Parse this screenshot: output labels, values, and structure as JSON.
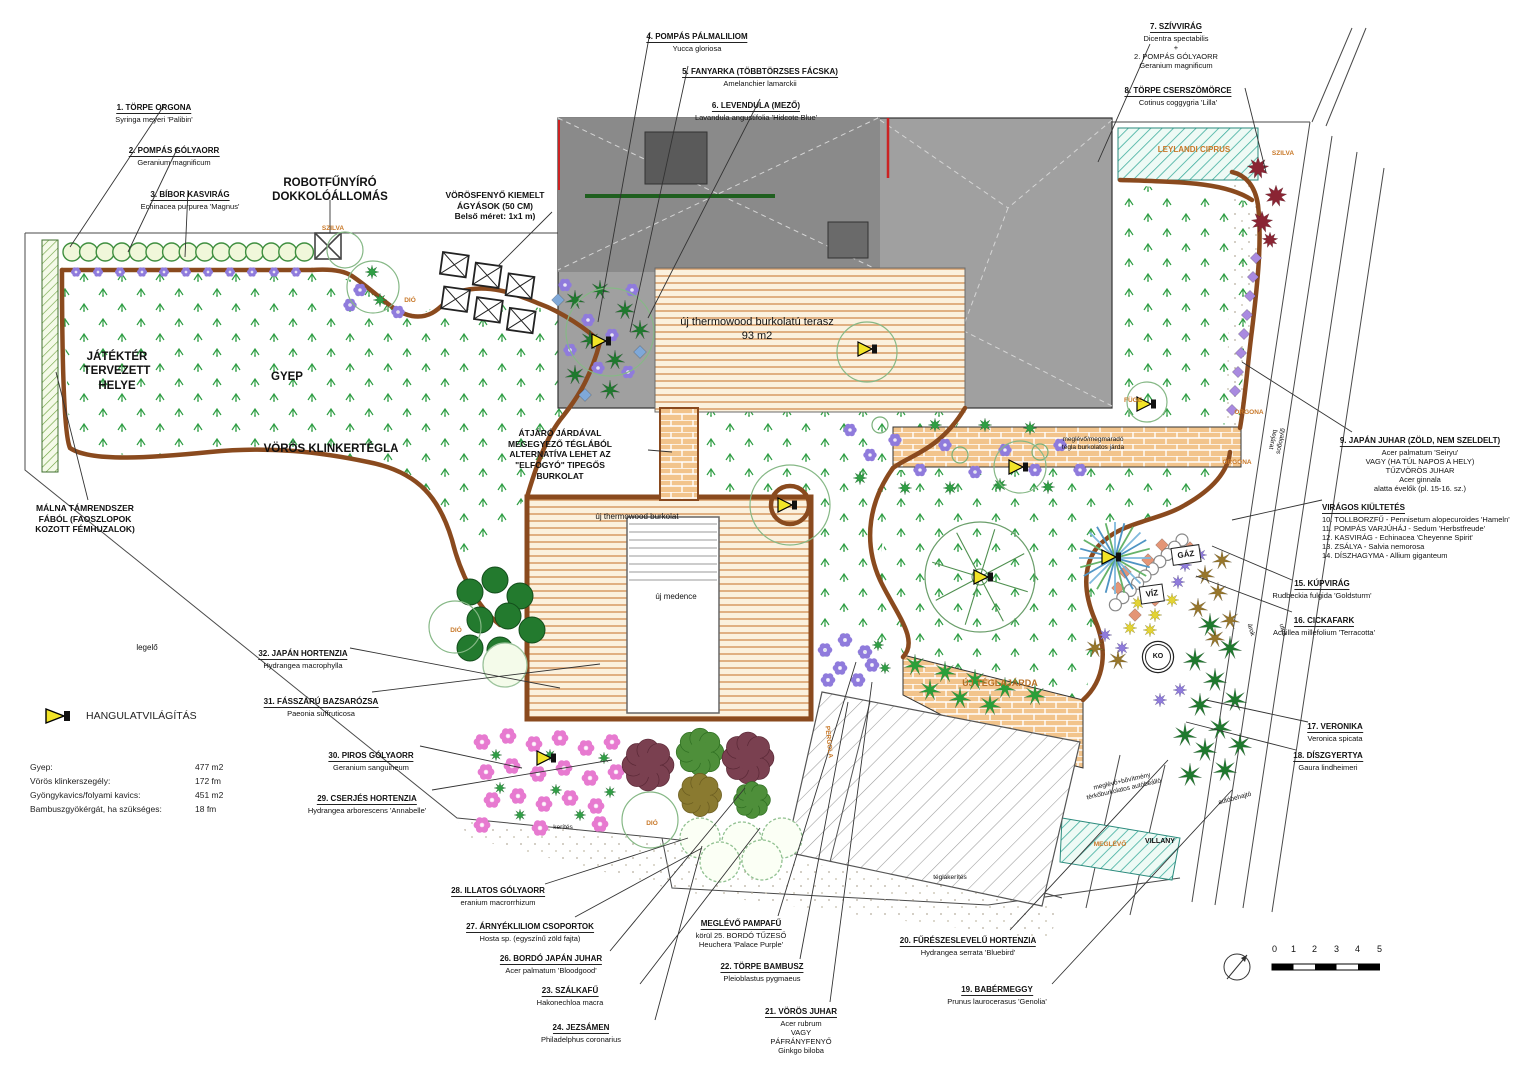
{
  "meta": {
    "drawing_type": "kertépítészeti terv (garden landscape plan)"
  },
  "colors": {
    "edging": "#8a4a1e",
    "lawn_symbol": "#2f9e44",
    "brick": "#e8b071",
    "terrace_stripe": "#d9a06b",
    "house": "#9a9a9a",
    "accent_orange": "#c87828",
    "lighting_yellow": "#f2e428",
    "teal_hatch": "#3fae9e",
    "red_accent": "#cc2222"
  },
  "plant_labels": [
    {
      "name": "plant-label-1",
      "title": "1. TÖRPE ORGONA",
      "latin": "Syringa meyeri 'Palibin'",
      "x": 154,
      "y": 96
    },
    {
      "name": "plant-label-2",
      "title": "2. POMPÁS GÓLYAORR",
      "latin": "Geranium magnificum",
      "x": 174,
      "y": 139
    },
    {
      "name": "plant-label-3",
      "title": "3. BÍBOR KASVIRÁG",
      "latin": "Echinacea purpurea 'Magnus'",
      "x": 190,
      "y": 183
    },
    {
      "name": "plant-label-4",
      "title": "4. POMPÁS PÁLMALILIOM",
      "latin": "Yucca gloriosa",
      "x": 697,
      "y": 25
    },
    {
      "name": "plant-label-5",
      "title": "5. FANYARKA (TÖBBTÖRZSES FÁCSKA)",
      "latin": "Amelanchier lamarckii",
      "x": 760,
      "y": 60
    },
    {
      "name": "plant-label-6",
      "title": "6. LEVENDULA (MEZŐ)",
      "latin": "Lavandula angustifolia 'Hidcote Blue'",
      "x": 756,
      "y": 94
    },
    {
      "name": "plant-label-7",
      "title": "7. SZÍVVIRÁG",
      "latin": "Dicentra spectabilis\n+\n2. POMPÁS GÓLYAORR\nGeranium magnificum",
      "x": 1176,
      "y": 15
    },
    {
      "name": "plant-label-8",
      "title": "8. TÖRPE CSERSZÖMÖRCE",
      "latin": "Cotinus coggygria 'Lilla'",
      "x": 1178,
      "y": 79
    },
    {
      "name": "plant-label-9",
      "title": "9. JAPÁN JUHAR (ZÖLD, NEM SZELDELT)",
      "latin": "Acer palmatum 'Seiryu'\nVAGY (HA TÚL NAPOS A HELY)\nTŰZVÖRÖS JUHAR\nAcer ginnala\nalatta évelők (pl. 15-16. sz.)",
      "x": 1420,
      "y": 429
    },
    {
      "name": "plant-label-viragos",
      "title": "VIRÁGOS KIÜLTETÉS",
      "latin": "10. TOLLBORZFŰ - Pennisetum alopecuroides 'Hameln'\n11. POMPÁS VARJÚHÁJ - Sedum 'Herbstfreude'\n12. KASVIRÁG - Echinacea 'Cheyenne Spirit'\n13. ZSÁLYA - Salvia nemorosa\n14. DÍSZHAGYMA - Allium giganteum",
      "x": 1322,
      "y": 496,
      "align": "left"
    },
    {
      "name": "plant-label-15",
      "title": "15. KÚPVIRÁG",
      "latin": "Rudbeckia fulgida 'Goldsturm'",
      "x": 1322,
      "y": 572
    },
    {
      "name": "plant-label-16",
      "title": "16. CICKAFARK",
      "latin": "Achillea millefolium 'Terracotta'",
      "x": 1324,
      "y": 609
    },
    {
      "name": "plant-label-17",
      "title": "17. VERONIKA",
      "latin": "Veronica spicata",
      "x": 1335,
      "y": 715
    },
    {
      "name": "plant-label-18",
      "title": "18. DÍSZGYERTYA",
      "latin": "Gaura lindheimeri",
      "x": 1328,
      "y": 744
    },
    {
      "name": "plant-label-19",
      "title": "19. BABÉRMEGGY",
      "latin": "Prunus laurocerasus 'Genolia'",
      "x": 997,
      "y": 978
    },
    {
      "name": "plant-label-20",
      "title": "20. FŰRÉSZESLEVELŰ HORTENZIA",
      "latin": "Hydrangea serrata 'Bluebird'",
      "x": 968,
      "y": 929
    },
    {
      "name": "plant-label-21",
      "title": "21. VÖRÖS JUHAR",
      "latin": "Acer rubrum\nVAGY\nPÁFRÁNYFENYŐ\nGinkgo biloba",
      "x": 801,
      "y": 1000
    },
    {
      "name": "plant-label-22",
      "title": "22. TÖRPE BAMBUSZ",
      "latin": "Pleioblastus pygmaeus",
      "x": 762,
      "y": 955
    },
    {
      "name": "plant-label-pampafu",
      "title": "MEGLÉVŐ PAMPAFŰ",
      "latin": "körül 25. BORDÓ TŰZESŐ\nHeuchera 'Palace Purple'",
      "x": 741,
      "y": 912
    },
    {
      "name": "plant-label-23",
      "title": "23. SZÁLKAFŰ",
      "latin": "Hakonechloa macra",
      "x": 570,
      "y": 979
    },
    {
      "name": "plant-label-24",
      "title": "24. JEZSÁMEN",
      "latin": "Philadelphus coronarius",
      "x": 581,
      "y": 1016
    },
    {
      "name": "plant-label-26",
      "title": "26. BORDÓ JAPÁN JUHAR",
      "latin": "Acer palmatum 'Bloodgood'",
      "x": 551,
      "y": 947
    },
    {
      "name": "plant-label-27",
      "title": "27. ÁRNYÉKLILIOM CSOPORTOK",
      "latin": "Hosta sp. (egyszínű zöld fajta)",
      "x": 530,
      "y": 915
    },
    {
      "name": "plant-label-28",
      "title": "28. ILLATOS GÓLYAORR",
      "latin": "eranium macrorrhizum",
      "x": 498,
      "y": 879
    },
    {
      "name": "plant-label-29",
      "title": "29. CSERJÉS HORTENZIA",
      "latin": "Hydrangea arborescens 'Annabelle'",
      "x": 367,
      "y": 787
    },
    {
      "name": "plant-label-30",
      "title": "30. PIROS GÓLYAORR",
      "latin": "Geranium sanguineum",
      "x": 371,
      "y": 744
    },
    {
      "name": "plant-label-31",
      "title": "31. FÁSSZÁRÚ BAZSARÓZSA",
      "latin": "Paeonia suffruticosa",
      "x": 321,
      "y": 690
    },
    {
      "name": "plant-label-32",
      "title": "32. JAPÁN HORTENZIA",
      "latin": "Hydrangea macrophylla",
      "x": 303,
      "y": 642
    }
  ],
  "notes": [
    {
      "name": "robot-dock-note",
      "text": "ROBOTFŰNYÍRÓ\nDOKKOLÓÁLLOMÁS",
      "x": 330,
      "y": 176,
      "cls": "b12"
    },
    {
      "name": "raised-beds-note",
      "text": "VÖRÖSFENYŐ KIEMELT\nÁGYÁSOK (50 CM)\nBelső méret: 1x1 m)",
      "x": 495,
      "y": 190,
      "cls": "b9"
    },
    {
      "name": "playground-note",
      "text": "JÁTÉKTÉR\nTERVEZETT\nHELYE",
      "x": 117,
      "y": 350,
      "cls": "b12"
    },
    {
      "name": "lawn-note",
      "text": "GYEP",
      "x": 287,
      "y": 370,
      "cls": "b12"
    },
    {
      "name": "klinker-note",
      "text": "VÖRÖS KLINKERTÉGLA",
      "x": 331,
      "y": 442,
      "cls": "b12"
    },
    {
      "name": "walkway-alt-note",
      "text": "ÁTJÁRÓ JÁRDÁVAL\nMEGEGYEZŐ TÉGLÁBÓL\nALTERNATÍVA LEHET AZ\n\"ELFOGYÓ\" TIPEGŐS\nBURKOLAT",
      "x": 560,
      "y": 428,
      "cls": "b9"
    },
    {
      "name": "raspberry-note",
      "text": "MÁLNA TÁMRENDSZER\nFÁBÓL (FAOSZLOPOK\nKOZOTT FÉMHUZALOK)",
      "x": 85,
      "y": 503,
      "cls": "b9"
    },
    {
      "name": "terrace-note",
      "text": "új thermowood burkolatú terasz\n93 m2",
      "x": 757,
      "y": 316,
      "cls": "t11"
    },
    {
      "name": "deck-note",
      "text": "új thermowood burkolat",
      "x": 637,
      "y": 512,
      "cls": "t8"
    },
    {
      "name": "pool-note",
      "text": "új medence",
      "x": 676,
      "y": 592,
      "cls": "t8"
    },
    {
      "name": "new-brick-walk-note",
      "text": "ÚJ TÉGLAJÁRDA",
      "x": 1000,
      "y": 678,
      "cls": "o9"
    },
    {
      "name": "pasture-note",
      "text": "legelő",
      "x": 147,
      "y": 643,
      "cls": "t8"
    },
    {
      "name": "leylandi-note",
      "text": "LEYLANDI CIPRUS",
      "x": 1194,
      "y": 145,
      "cls": "o8"
    },
    {
      "name": "plum-right-note",
      "text": "SZILVA",
      "x": 1283,
      "y": 150,
      "cls": "o7"
    },
    {
      "name": "plum-left-note",
      "text": "SZILVA",
      "x": 333,
      "y": 225,
      "cls": "o7"
    },
    {
      "name": "walnut1-note",
      "text": "DIÓ",
      "x": 410,
      "y": 297,
      "cls": "o7"
    },
    {
      "name": "walnut2-note",
      "text": "DIÓ",
      "x": 456,
      "y": 627,
      "cls": "o7"
    },
    {
      "name": "walnut3-note",
      "text": "DIÓ",
      "x": 652,
      "y": 820,
      "cls": "o7"
    },
    {
      "name": "fig-note",
      "text": "FÜGE",
      "x": 1133,
      "y": 397,
      "cls": "o7"
    },
    {
      "name": "lilac1-note",
      "text": "ORGONA",
      "x": 1249,
      "y": 409,
      "cls": "o7"
    },
    {
      "name": "lilac2-note",
      "text": "ORGONA",
      "x": 1237,
      "y": 459,
      "cls": "o7"
    },
    {
      "name": "existing-brick-walk-note",
      "text": "meglévő/megmaradó\ntégla burkolatos járda",
      "x": 1093,
      "y": 436,
      "cls": "tiny"
    },
    {
      "name": "pedestrian-gate-note",
      "text": "gyalogos\nbejárat",
      "x": 1263,
      "y": 432,
      "cls": "tiny",
      "rot": 102
    },
    {
      "name": "gas-tag",
      "text": "GÁZ",
      "x": 1186,
      "y": 546,
      "cls": "box"
    },
    {
      "name": "water-tag",
      "text": "VÍZ",
      "x": 1152,
      "y": 585,
      "cls": "box"
    },
    {
      "name": "well-tag",
      "text": "KO",
      "x": 1158,
      "y": 644,
      "cls": "circ"
    },
    {
      "name": "ditch-note",
      "text": "árok",
      "x": 1244,
      "y": 626,
      "cls": "tiny",
      "rot": 74
    },
    {
      "name": "street-note",
      "text": "utca",
      "x": 1276,
      "y": 626,
      "cls": "tiny",
      "rot": 74
    },
    {
      "name": "pergola-note",
      "text": "PERGOLA",
      "x": 812,
      "y": 738,
      "cls": "o7",
      "rot": 84
    },
    {
      "name": "parking-note",
      "text": "meglévő+bővítmény\ntérkőburkolatos autóbeálló",
      "x": 1085,
      "y": 778,
      "cls": "tiny",
      "rot": -13
    },
    {
      "name": "car-gate-note",
      "text": "autóbehajtó",
      "x": 1218,
      "y": 795,
      "cls": "tiny",
      "rot": -15
    },
    {
      "name": "electric-note",
      "text": "VILLANY",
      "x": 1160,
      "y": 838,
      "cls": "b7"
    },
    {
      "name": "existing-hedge-note",
      "text": "MEGLÉVŐ",
      "x": 1110,
      "y": 841,
      "cls": "o7"
    },
    {
      "name": "fence-note",
      "text": "kerítés",
      "x": 563,
      "y": 824,
      "cls": "tiny"
    },
    {
      "name": "brick-fence-note",
      "text": "téglakerítés",
      "x": 950,
      "y": 874,
      "cls": "tiny"
    }
  ],
  "legend": {
    "lighting_label": "HANGULATVILÁGÍTÁS",
    "rows": [
      {
        "label": "Gyep:",
        "value": "477 m2"
      },
      {
        "label": "Vörös klinkerszegély:",
        "value": "172 fm"
      },
      {
        "label": "Gyöngykavics/folyami kavics:",
        "value": "451 m2"
      },
      {
        "label": "Bambuszgyökérgát, ha szükséges:",
        "value": "18 fm"
      }
    ]
  },
  "scale_bar": {
    "ticks": [
      "0",
      "1",
      "2",
      "3",
      "4",
      "5"
    ]
  }
}
